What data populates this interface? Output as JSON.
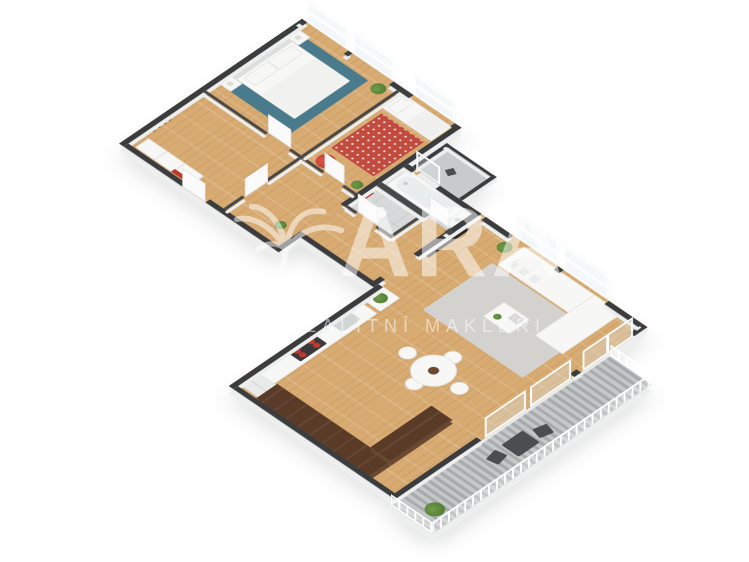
{
  "watermark": {
    "brand": "ARA",
    "tagline": "REALITNÍ MAKLÉŘI",
    "icon": "palm-tree-icon",
    "color": "#ffffff"
  },
  "palette": {
    "bg": "#ffffff",
    "wall": "#3b3c3e",
    "wall_int": "#47484a",
    "wall_side": "#edefef",
    "wood": "#d8ab72",
    "tile": "#d8d9da",
    "deck_a": "#a6aaac",
    "deck_b": "#c5c7c8",
    "terrace": "#c9cacb",
    "kitchen_wood": "#5a3b27",
    "kitchen_wood_2": "#6b4830",
    "rug_blue": "#4a7b8d",
    "rug_red": "#c14b3e",
    "rug_gray": "#d4d2cf",
    "white_furn": "#f7f7f5",
    "furn_border": "#e2e2e0",
    "red_accent": "#c0392b",
    "green": "#567f35",
    "green_2": "#6f9c4a",
    "dark": "#4b4e51",
    "tv": "#27282a"
  },
  "scene": {
    "type": "isometric-3d-floor-plan-render",
    "rooms": [
      {
        "name": "master-bedroom",
        "floor": "wood",
        "furniture": [
          "double-bed",
          "two-nightstands",
          "blue-rug",
          "plant"
        ]
      },
      {
        "name": "kids-bedroom",
        "floor": "wood",
        "furniture": [
          "single-bed",
          "red-patterned-rug",
          "red-beanbag",
          "plant"
        ]
      },
      {
        "name": "entry-hall",
        "floor": "wood",
        "furniture": [
          "wardrobe",
          "coat-hooks",
          "red-wall-accent"
        ]
      },
      {
        "name": "hallway",
        "floor": "wood",
        "furniture": [
          "plant"
        ]
      },
      {
        "name": "wc",
        "floor": "tile",
        "furniture": [
          "toilet",
          "red-towel"
        ]
      },
      {
        "name": "bathroom",
        "floor": "tile",
        "furniture": [
          "bathtub",
          "vanity"
        ]
      },
      {
        "name": "small-terrace",
        "floor": "concrete",
        "furniture": [
          "chair"
        ]
      },
      {
        "name": "kitchen",
        "floor": "wood",
        "furniture": [
          "fridge",
          "worktop-with-hob",
          "sink",
          "island-with-plant",
          "l-shaped-dark-counter"
        ]
      },
      {
        "name": "dining-area",
        "floor": "wood",
        "furniture": [
          "round-table",
          "four-chairs",
          "centerpiece"
        ]
      },
      {
        "name": "living-room",
        "floor": "wood",
        "furniture": [
          "corner-sofa",
          "coffee-table",
          "gray-rug",
          "wall-tv",
          "plant"
        ]
      },
      {
        "name": "balcony",
        "floor": "decking",
        "furniture": [
          "outdoor-table",
          "two-outdoor-chairs",
          "bush",
          "white-railing"
        ]
      }
    ],
    "window_count": 8,
    "door_count": 7
  }
}
